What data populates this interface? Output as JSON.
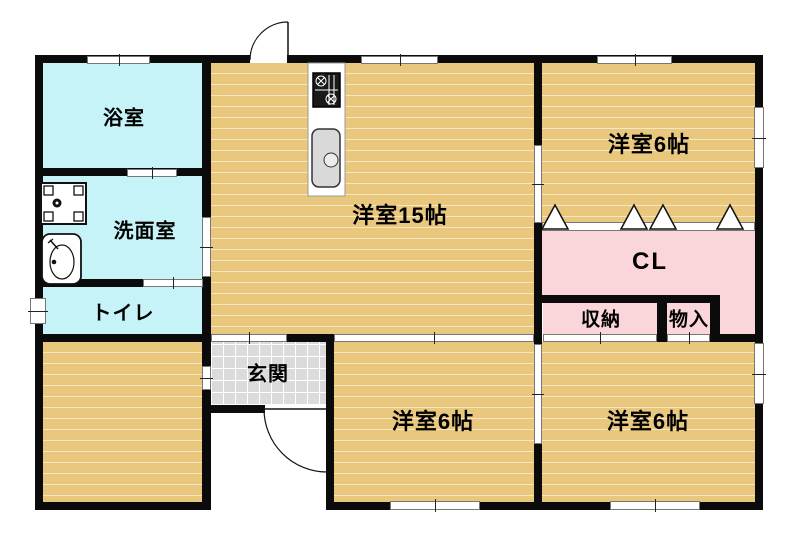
{
  "plan_title": "floor-plan",
  "colors": {
    "wood": "#E9C87D",
    "water": "#C6F3F8",
    "pink": "#FAD6DB",
    "tile": "#DBDBDB",
    "wall": "#0B0B0B"
  },
  "rooms": {
    "bath": {
      "label": "浴室"
    },
    "washroom": {
      "label": "洗面室"
    },
    "toilet": {
      "label": "トイレ"
    },
    "entrance": {
      "label": "玄関"
    },
    "living": {
      "label": "洋室15帖"
    },
    "bedroom_ne": {
      "label": "洋室6帖"
    },
    "bedroom_sw": {
      "label": "洋室6帖"
    },
    "bedroom_se": {
      "label": "洋室6帖"
    },
    "closet": {
      "label": "CL"
    },
    "storage": {
      "label": "収納"
    },
    "cabinet": {
      "label": "物入"
    }
  }
}
